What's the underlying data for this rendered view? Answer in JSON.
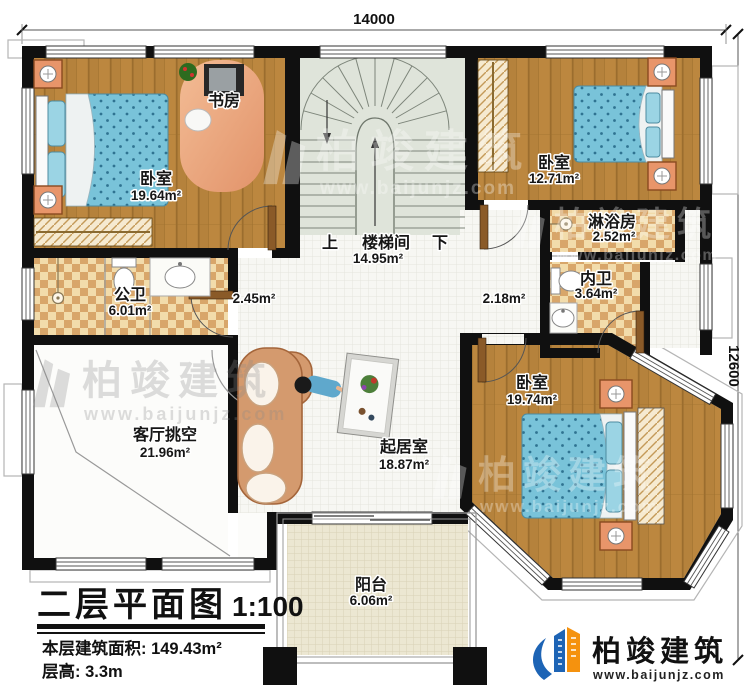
{
  "dimensions": {
    "width_label": "14000",
    "height_label": "12600"
  },
  "rooms": {
    "bedroom_tl": {
      "name": "卧室",
      "area": "19.64m²"
    },
    "study": {
      "name": "书房"
    },
    "stairwell": {
      "name": "楼梯间",
      "area": "14.95m²",
      "up": "上",
      "down": "下"
    },
    "bedroom_tr": {
      "name": "卧室",
      "area": "12.71m²"
    },
    "shower_room": {
      "name": "淋浴房",
      "area": "2.52m²"
    },
    "inner_bath": {
      "name": "内卫",
      "area": "3.64m²"
    },
    "public_bath": {
      "name": "公卫",
      "area": "6.01m²"
    },
    "hall_left": {
      "area": "2.45m²"
    },
    "hall_right": {
      "area": "2.18m²"
    },
    "living_void": {
      "name": "客厅挑空",
      "area": "21.96m²"
    },
    "family_room": {
      "name": "起居室",
      "area": "18.87m²"
    },
    "bedroom_br": {
      "name": "卧室",
      "area": "19.74m²"
    },
    "balcony": {
      "name": "阳台",
      "area": "6.06m²"
    }
  },
  "title_block": {
    "title": "二层平面图",
    "scale": "1:100",
    "area_line": "本层建筑面积: 149.43m²",
    "height_line": "层高: 3.3m"
  },
  "branding": {
    "company": "柏竣建筑",
    "website": "www.baijunjz.com"
  },
  "watermark": {
    "company": "柏竣建筑",
    "website": "www.baijunjz.com"
  },
  "colors": {
    "wall": "#101010",
    "wood_floor": "#b5823c",
    "tile_light": "#f2dcab",
    "tile_dark": "#d8a66a",
    "stair": "#dfe4da",
    "bed_blue": "#79c3d9",
    "logo_blue": "#1d64b5",
    "logo_orange": "#f5920e"
  }
}
